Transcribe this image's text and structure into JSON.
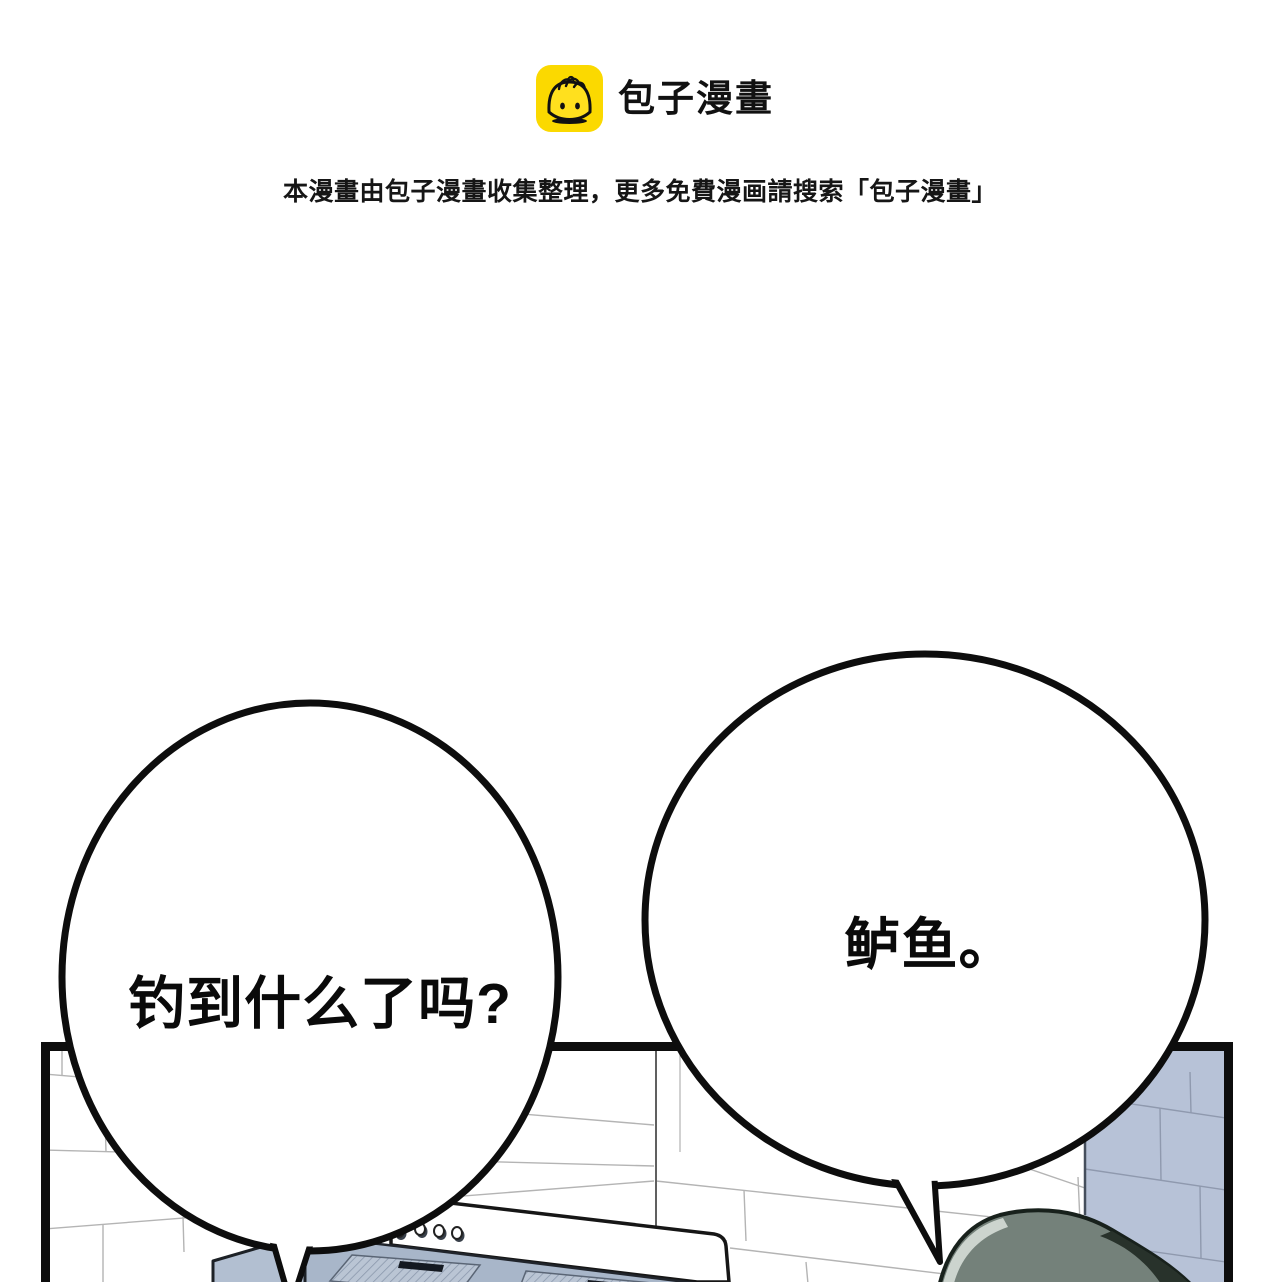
{
  "header": {
    "logo": {
      "label": "包子漫畫",
      "icon": "baozi-bun-face",
      "bg_color": "#FBD900"
    },
    "notice": "本漫畫由包子漫畫收集整理，更多免費漫画請搜索「包子漫畫」"
  },
  "dialogue": {
    "left_bubble": {
      "text": "钓到什么了吗?"
    },
    "right_bubble": {
      "text": "鲈鱼。"
    }
  },
  "panel": {
    "colors": {
      "panel_border": "#0d0d0d",
      "white_tile_line": "#b4b4b4",
      "blue_wall": "#b7c2d7",
      "blue_wall_line": "#8f99ae",
      "hood_underside": "#a8b6c9",
      "hood_filter": "#bac5d4",
      "hood_slot": "#141921",
      "hair_main": "#74817a",
      "hair_shadow": "#28322b",
      "hair_highlight": "#ccd4ce"
    }
  }
}
